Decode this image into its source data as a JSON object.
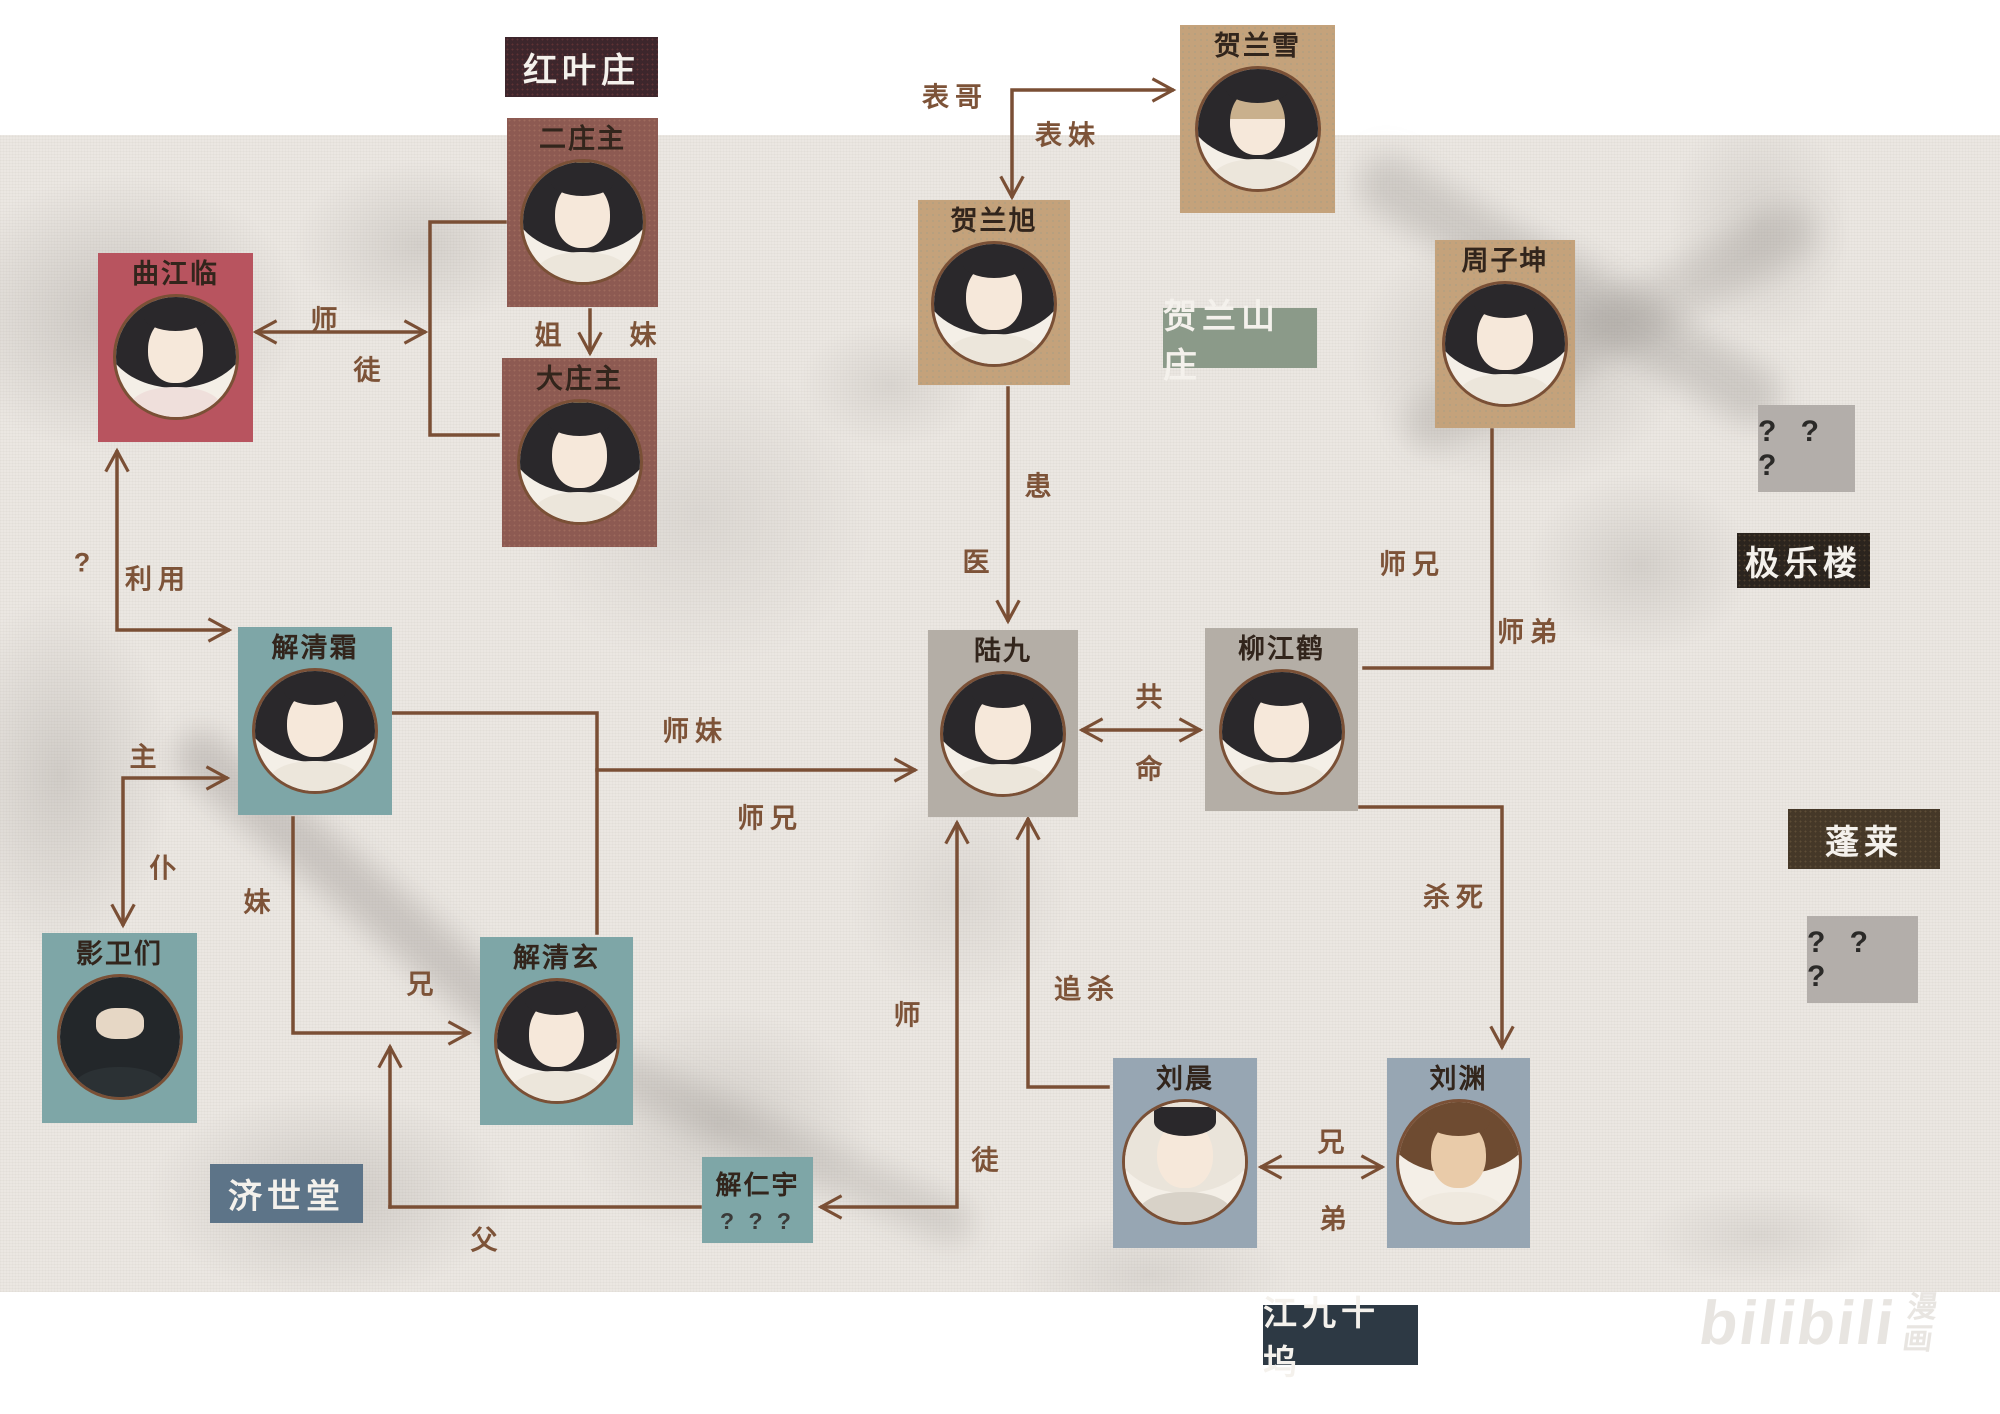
{
  "colors": {
    "line": "#7a4f35",
    "label_text": "#7d5338",
    "name_text": "#32251c",
    "card_rose": "#b8545f",
    "card_mauve": "#8d5a52",
    "card_tan": "#c4a27b",
    "card_gray": "#b4aea6",
    "card_teal": "#7ea6a7",
    "card_slate": "#97a6b3",
    "box_maroon": "#3d262c",
    "box_sage": "#8b9a89",
    "box_black": "#2b241e",
    "box_brown": "#453828",
    "box_steel": "#5d7488",
    "box_navy": "#2d3944",
    "box_gray": "#b3aeaa",
    "paper": "#ebe7e2"
  },
  "characters": [
    {
      "name": "曲江临"
    },
    {
      "name": "二庄主"
    },
    {
      "name": "大庄主"
    },
    {
      "name": "贺兰雪"
    },
    {
      "name": "贺兰旭"
    },
    {
      "name": "周子坤"
    },
    {
      "name": "陆九"
    },
    {
      "name": "柳江鹤"
    },
    {
      "name": "解清霜"
    },
    {
      "name": "影卫们"
    },
    {
      "name": "解清玄"
    },
    {
      "name": "刘晨"
    },
    {
      "name": "刘渊"
    },
    {
      "name": "解仁宇",
      "subtitle": "? ? ?"
    }
  ],
  "factions": [
    {
      "name": "红叶庄"
    },
    {
      "name": "贺兰山庄"
    },
    {
      "name": "极乐楼"
    },
    {
      "name": "蓬莱"
    },
    {
      "name": "济世堂"
    },
    {
      "name": "江九十坞"
    },
    {
      "name": "? ? ?"
    },
    {
      "name": "? ? ?"
    }
  ],
  "relations": [
    {
      "text": "师"
    },
    {
      "text": "徒"
    },
    {
      "text": "姐"
    },
    {
      "text": "妹"
    },
    {
      "text": "表哥"
    },
    {
      "text": "表妹"
    },
    {
      "text": "患"
    },
    {
      "text": "医"
    },
    {
      "text": "师兄"
    },
    {
      "text": "师弟"
    },
    {
      "text": "共"
    },
    {
      "text": "命"
    },
    {
      "text": "?"
    },
    {
      "text": "利用"
    },
    {
      "text": "主"
    },
    {
      "text": "仆"
    },
    {
      "text": "妹"
    },
    {
      "text": "兄"
    },
    {
      "text": "师妹"
    },
    {
      "text": "师兄"
    },
    {
      "text": "师"
    },
    {
      "text": "徒"
    },
    {
      "text": "追杀"
    },
    {
      "text": "杀死"
    },
    {
      "text": "兄"
    },
    {
      "text": "弟"
    },
    {
      "text": "父"
    }
  ],
  "watermark": {
    "logo": "bilibili",
    "label_top": "漫",
    "label_bottom": "画"
  }
}
